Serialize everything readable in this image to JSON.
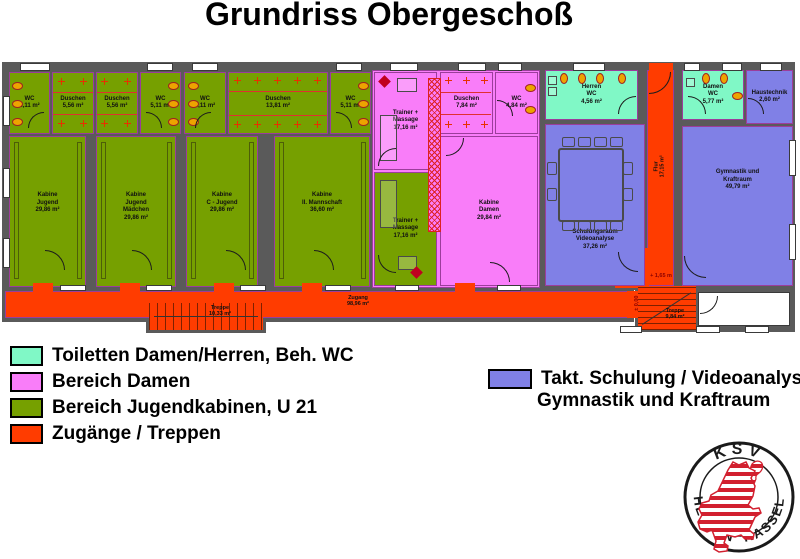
{
  "title": "Grundriss Obergeschoß",
  "colors": {
    "wall": "#5A5A5A",
    "toiletten": "#80F8C6",
    "damen": "#F97DF9",
    "jugendkabinen": "#76A000",
    "zugaenge": "#FF3C00",
    "schulung_gymnastik": "#8080E6",
    "logo_red": "#D2202F"
  },
  "icons": {
    "shower_cross": "+",
    "toilet": "oval-seat",
    "door": "quarter-arc"
  },
  "rooms": {
    "wc_a1": {
      "label": "WC\n5,11 m²"
    },
    "dusche_a1": {
      "label": "Duschen\n5,56 m²"
    },
    "dusche_a2": {
      "label": "Duschen\n5,56 m²"
    },
    "wc_a2": {
      "label": "WC\n5,11 m²"
    },
    "wc_b1": {
      "label": "WC\n5,11 m²"
    },
    "dusche_b": {
      "label": "Duschen\n13,81 m²"
    },
    "wc_b2": {
      "label": "WC\n5,11 m²"
    },
    "kabine1": {
      "label": "Kabine\nJugend\n29,86 m²"
    },
    "kabine2": {
      "label": "Kabine\nJugend\nMädchen\n29,86 m²"
    },
    "kabine3": {
      "label": "Kabine\nC - Jugend\n29,86 m²"
    },
    "kabine4": {
      "label": "Kabine\nII. Mannschaft\n36,60 m²"
    },
    "trainer_oben": {
      "label": "Trainer +\nMassage\n17,16 m²"
    },
    "trainer_unten": {
      "label": "Trainer +\nMassage\n17,16 m²"
    },
    "dusche_damen": {
      "label": "Duschen\n7,84 m²"
    },
    "wc_damen_klein": {
      "label": "WC\n4,84 m²"
    },
    "kabine_damen": {
      "label": "Kabine\nDamen\n29,84 m²"
    },
    "herren_wc": {
      "label": "Herren\nWC\n4,56 m²"
    },
    "damen_wc": {
      "label": "Damen\nWC\n5,77 m²"
    },
    "haustechnik": {
      "label": "Haustechnik\n2,60 m²"
    },
    "schulung": {
      "label": "Schulungsraum\nVideoanalyse\n37,26 m²"
    },
    "gymnastik": {
      "label": "Gymnastik und\nKraftraum\n49,79 m²"
    },
    "flur": {
      "label": "Flur\n17,15 m²"
    },
    "zugang": {
      "label": "Zugang\n98,96 m²"
    },
    "treppe_links": {
      "label": "Treppe\n10,33 m²"
    },
    "treppe_rechts": {
      "label": "Treppe\n9,84 m²"
    }
  },
  "annotations": {
    "level_up": "+ 1,65 m",
    "level_zero": "± 0,00"
  },
  "legend_left": [
    {
      "label": "Toiletten Damen/Herren, Beh. WC",
      "color": "#80F8C6"
    },
    {
      "label": "Bereich Damen",
      "color": "#F97DF9"
    },
    {
      "label": "Bereich Jugendkabinen, U 21",
      "color": "#76A000"
    },
    {
      "label": "Zugänge / Treppen",
      "color": "#FF3C00"
    }
  ],
  "legend_right": {
    "color": "#8080E6",
    "line1": "Takt. Schulung / Videoanalyse",
    "line2": "Gymnastik und Kraftraum"
  },
  "logo": {
    "top": "KSV",
    "bottom_left": "HESSEN",
    "bottom_right": "KASSEL"
  }
}
